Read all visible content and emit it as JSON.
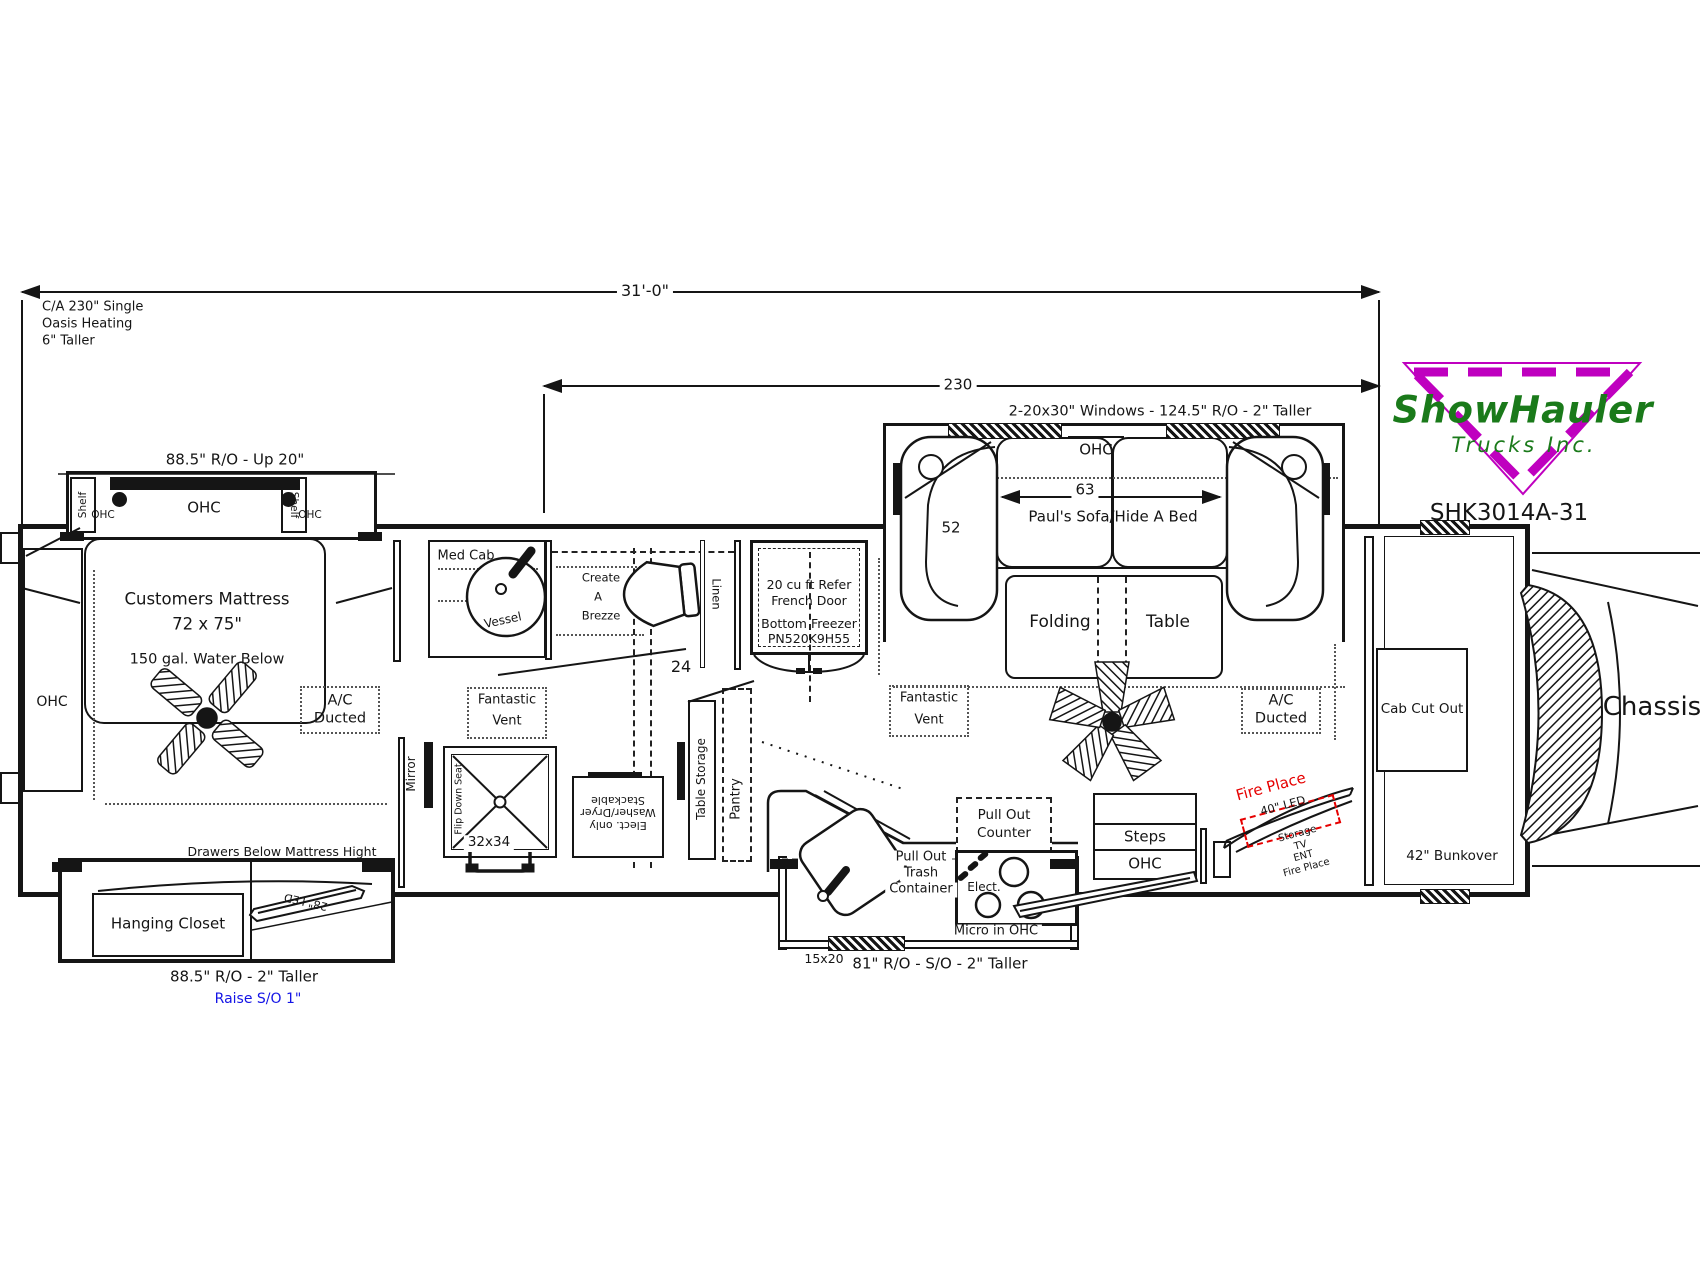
{
  "title_block": {
    "model": "SHK3014A-31"
  },
  "brand": {
    "name": "ShowHauler",
    "subtitle": "Trucks Inc.",
    "color_green": "#1a7a1a",
    "color_magenta": "#bf00bf"
  },
  "notes": {
    "line1": "C/A 230\" Single",
    "line2": "Oasis Heating",
    "line3": "6\" Taller"
  },
  "dimensions": {
    "overall_length": "31'-0\"",
    "body_length": "230",
    "window_note": "2-20x30\" Windows - 124.5\" R/O - 2\" Taller",
    "bed_slide_ro": "88.5\" R/O - Up 20\"",
    "closet_slide_ro": "88.5\" R/O - 2\" Taller",
    "closet_raise": "Raise S/O 1\"",
    "kitchen_ro": "81\" R/O - S/O - 2\" Taller",
    "kitchen_window": "15x20",
    "sofa_length": "63",
    "sofa_depth": "52",
    "bath_walkway": "24"
  },
  "bedroom": {
    "shelf_left": "Shelf",
    "shelf_right": "Shelf",
    "ohc_center": "OHC",
    "ohc_left": "OHC",
    "ohc_right": "OHC",
    "ohc_wall": "OHC",
    "mattress_title": "Customers Mattress",
    "mattress_size": "72 x 75\"",
    "water_note": "150 gal. Water Below",
    "ac_line1": "A/C",
    "ac_line2": "Ducted",
    "drawers_note": "Drawers Below Mattress Hight",
    "closet": "Hanging Closet",
    "tv": "28\" LED"
  },
  "bath": {
    "med_cab": "Med Cab",
    "sink": "Vessel",
    "toilet_line1": "Create",
    "toilet_line2": "A",
    "toilet_line3": "Brezze",
    "linen": "Linen",
    "vent_line1": "Fantastic",
    "vent_line2": "Vent",
    "mirror": "Mirror",
    "shower_size": "32x34",
    "shower_seat": "Flip Down Seat",
    "washer_line1": "Elect. only",
    "washer_line2": "Washer/Dryer",
    "washer_line3": "Stackable",
    "table_storage": "Table Storage",
    "pantry": "Pantry"
  },
  "fridge": {
    "line1": "20 cu ft Refer",
    "line2": "French Door",
    "line3": "Bottom Freezer",
    "line4": "PN520K9H55"
  },
  "living": {
    "ohc": "OHC",
    "sofa": "Paul's Sofa/Hide A Bed",
    "table_line1": "Folding",
    "table_line2": "Table",
    "vent_line1": "Fantastic",
    "vent_line2": "Vent",
    "ac_line1": "A/C",
    "ac_line2": "Ducted"
  },
  "kitchen": {
    "counter_line1": "Pull Out",
    "counter_line2": "Counter",
    "trash_line1": "Pull Out",
    "trash_line2": "Trash",
    "trash_line3": "Container",
    "cooktop": "Elect.",
    "micro": "Micro in OHC"
  },
  "rear": {
    "steps": "Steps",
    "steps_ohc": "OHC",
    "fireplace": "Fire Place",
    "fireplace_tv": "40\" LED",
    "cabinet_line1": "Storage",
    "cabinet_line2": "TV",
    "cabinet_line3": "ENT",
    "cabinet_line4": "Fire Place",
    "bunkover": "42\" Bunkover",
    "cab_cut_out": "Cab Cut Out",
    "chassis": "Chassis"
  },
  "colors": {
    "line": "#151515",
    "red": "#e60000",
    "blue": "#1414e6",
    "green": "#1a7a1a",
    "magenta": "#bf00bf"
  }
}
